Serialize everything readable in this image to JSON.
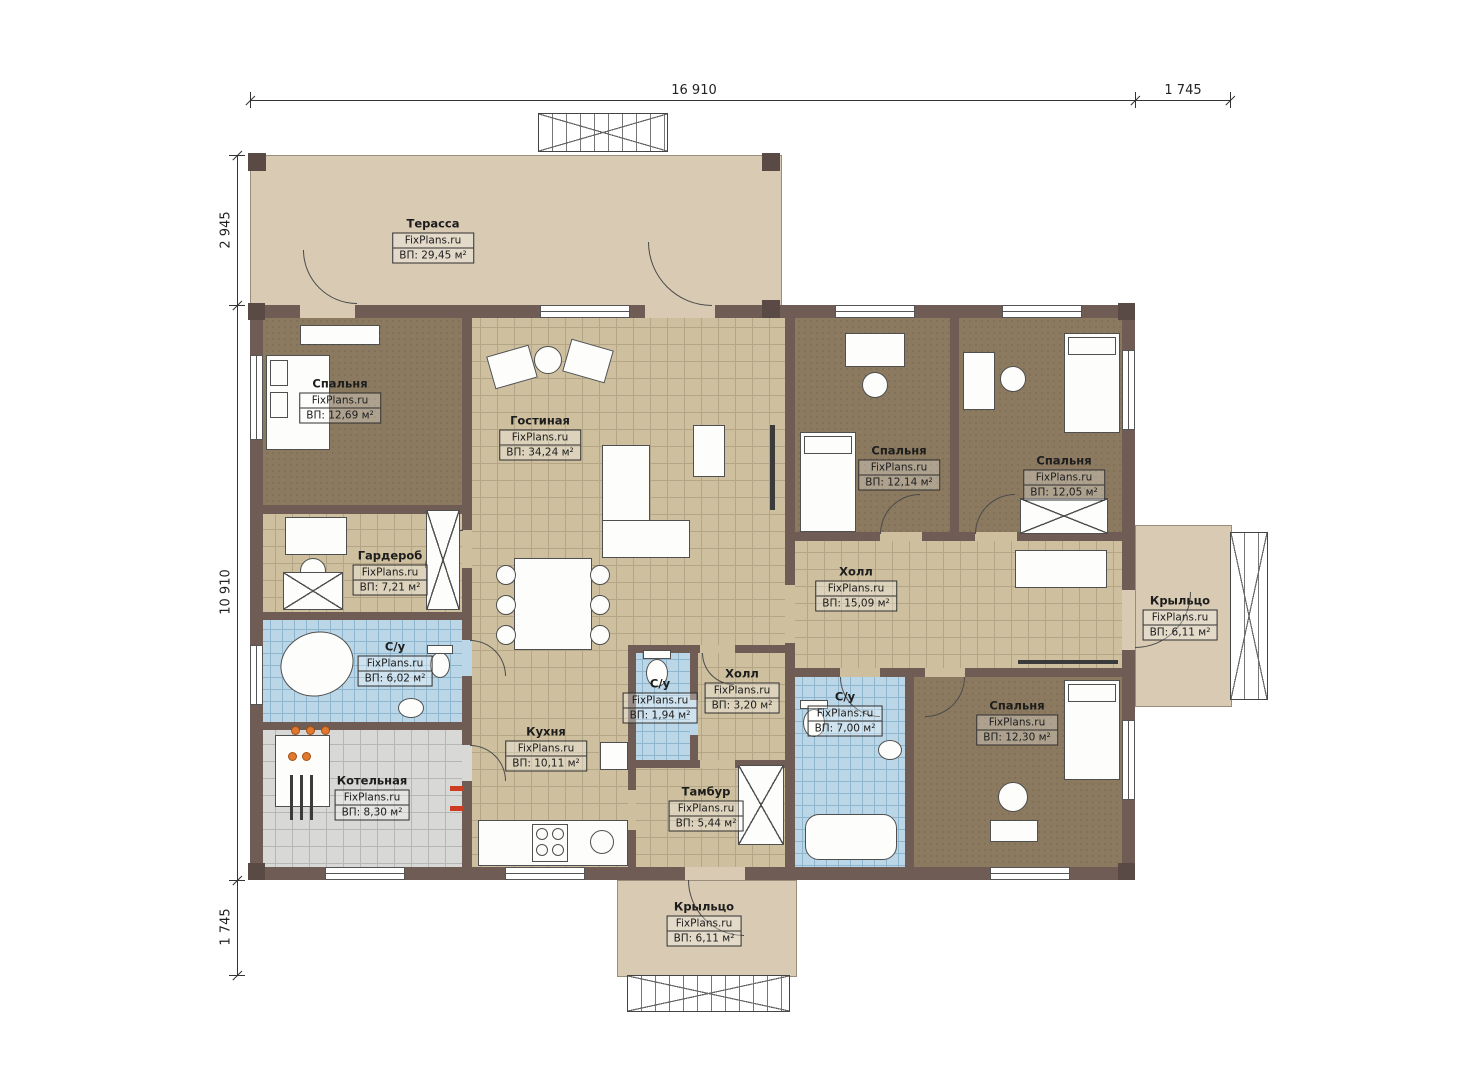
{
  "watermark": "FixPlans.ru",
  "dimensions": {
    "top_main": "16 910",
    "top_right": "1 745",
    "left_top": "2 945",
    "left_main": "10 910",
    "left_bottom": "1 745"
  },
  "rooms": {
    "terrace": {
      "name": "Терасса",
      "site": "FixPlans.ru",
      "area": "ВП: 29,45 м²"
    },
    "bedroom_tl": {
      "name": "Спальня",
      "site": "FixPlans.ru",
      "area": "ВП: 12,69 м²"
    },
    "living": {
      "name": "Гостиная",
      "site": "FixPlans.ru",
      "area": "ВП: 34,24 м²"
    },
    "wardrobe": {
      "name": "Гардероб",
      "site": "FixPlans.ru",
      "area": "ВП: 7,21 м²"
    },
    "bath_left": {
      "name": "С/у",
      "site": "FixPlans.ru",
      "area": "ВП: 6,02 м²"
    },
    "boiler": {
      "name": "Котельная",
      "site": "FixPlans.ru",
      "area": "ВП: 8,30 м²"
    },
    "kitchen": {
      "name": "Кухня",
      "site": "FixPlans.ru",
      "area": "ВП: 10,11 м²"
    },
    "bath_center": {
      "name": "С/у",
      "site": "FixPlans.ru",
      "area": "ВП: 1,94 м²"
    },
    "hall_small": {
      "name": "Холл",
      "site": "FixPlans.ru",
      "area": "ВП: 3,20 м²"
    },
    "tambour": {
      "name": "Тамбур",
      "site": "FixPlans.ru",
      "area": "ВП: 5,44 м²"
    },
    "hall_main": {
      "name": "Холл",
      "site": "FixPlans.ru",
      "area": "ВП: 15,09 м²"
    },
    "bedroom_t1": {
      "name": "Спальня",
      "site": "FixPlans.ru",
      "area": "ВП: 12,14 м²"
    },
    "bedroom_t2": {
      "name": "Спальня",
      "site": "FixPlans.ru",
      "area": "ВП: 12,05 м²"
    },
    "bath_right": {
      "name": "С/у",
      "site": "FixPlans.ru",
      "area": "ВП: 7,00 м²"
    },
    "bedroom_br": {
      "name": "Спальня",
      "site": "FixPlans.ru",
      "area": "ВП: 12,30 м²"
    },
    "porch_right": {
      "name": "Крыльцо",
      "site": "FixPlans.ru",
      "area": "ВП: 6,11 м²"
    },
    "porch_bottom": {
      "name": "Крыльцо",
      "site": "FixPlans.ru",
      "area": "ВП: 6,11 м²"
    }
  },
  "colors": {
    "wall": "#6e5c55",
    "terrace": "#d9cbb3",
    "floor_tan": "#cec09f",
    "floor_dark": "#8b7a5f",
    "tile_blue": "#bad6e7",
    "tile_gray": "#d8d8d6",
    "accent_orange": "#e07830",
    "accent_red": "#cc3b22"
  }
}
